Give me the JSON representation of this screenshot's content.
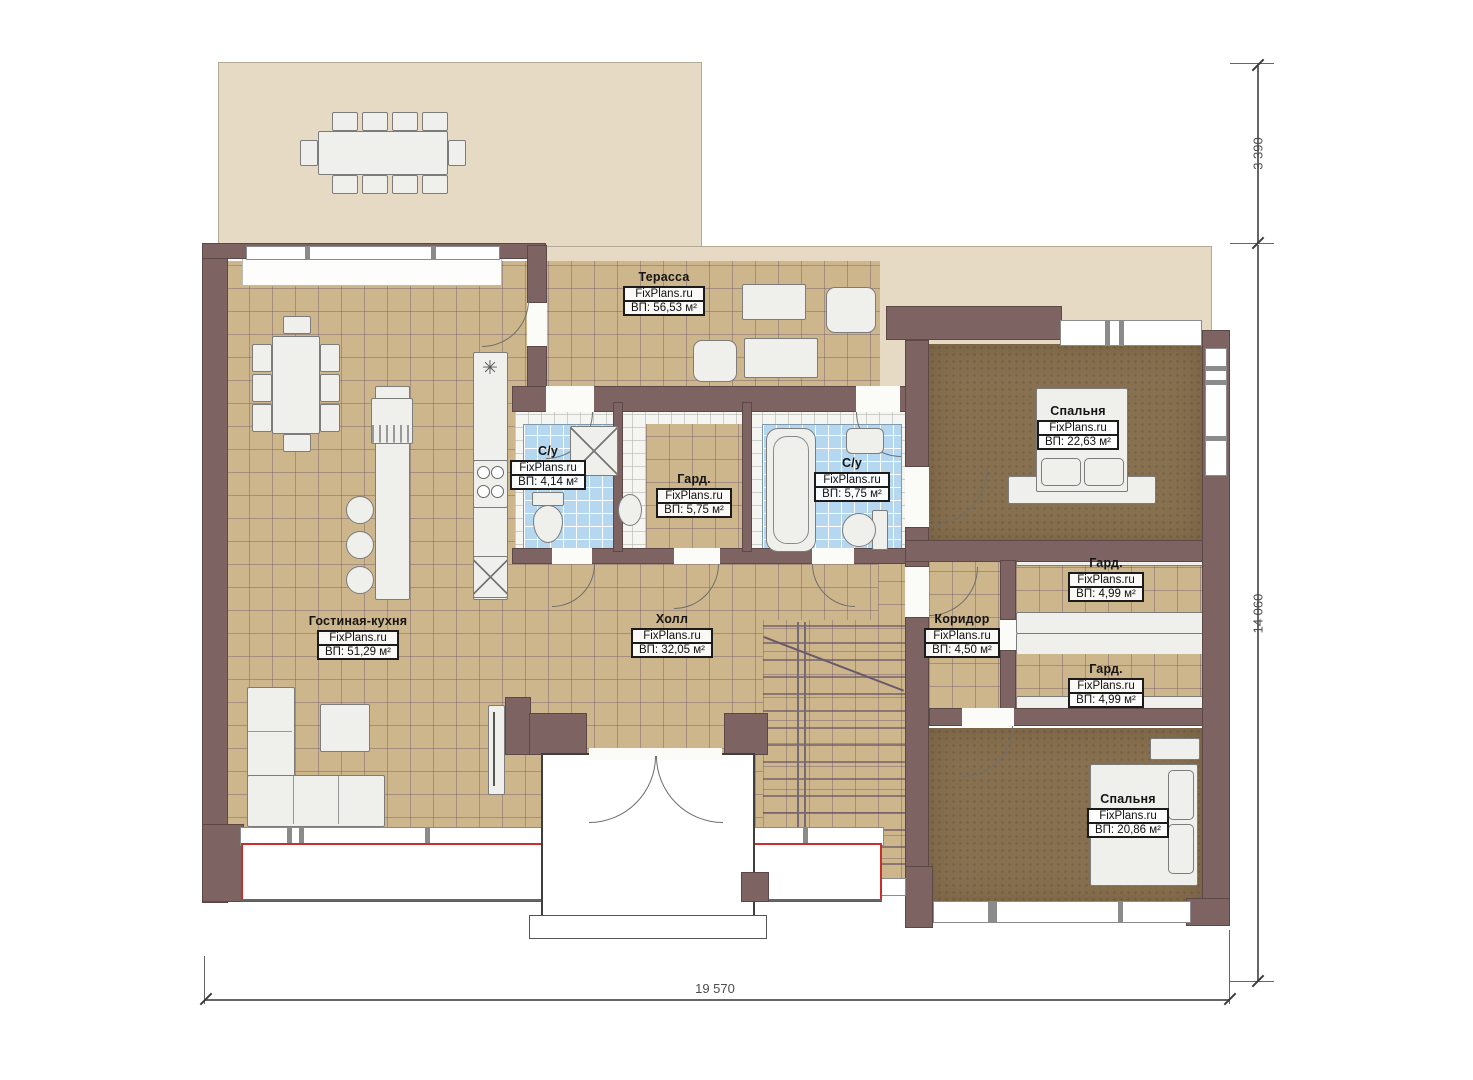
{
  "watermark": "FixPlans.ru",
  "dimensions": {
    "top_right": "3 390",
    "right_side": "14 060",
    "bottom": "19 570"
  },
  "rooms": {
    "terrace": {
      "name": "Терасса",
      "area": "ВП: 56,53 м²"
    },
    "bedroom_top": {
      "name": "Спальня",
      "area": "ВП: 22,63 м²"
    },
    "bathroom_small": {
      "name": "С/у",
      "area": "ВП: 4,14 м²"
    },
    "wardrobe_center": {
      "name": "Гард.",
      "area": "ВП: 5,75 м²"
    },
    "bathroom_large": {
      "name": "С/у",
      "area": "ВП: 5,75 м²"
    },
    "living_kitchen": {
      "name": "Гостиная-кухня",
      "area": "ВП: 51,29 м²"
    },
    "hall": {
      "name": "Холл",
      "area": "ВП: 32,05 м²"
    },
    "corridor": {
      "name": "Коридор",
      "area": "ВП: 4,50 м²"
    },
    "wardrobe_right_1": {
      "name": "Гард.",
      "area": "ВП: 4,99 м²"
    },
    "wardrobe_right_2": {
      "name": "Гард.",
      "area": "ВП: 4,99 м²"
    },
    "bedroom_bottom": {
      "name": "Спальня",
      "area": "ВП: 20,86 м²"
    }
  },
  "colors": {
    "wall": "#7e6363",
    "floor_tile": "#cdb68c",
    "floor_bedroom": "#87704f",
    "terrace": "#e7dac5",
    "bath_tile": "#b5d7f0",
    "red_marking": "#cc2d2d"
  }
}
